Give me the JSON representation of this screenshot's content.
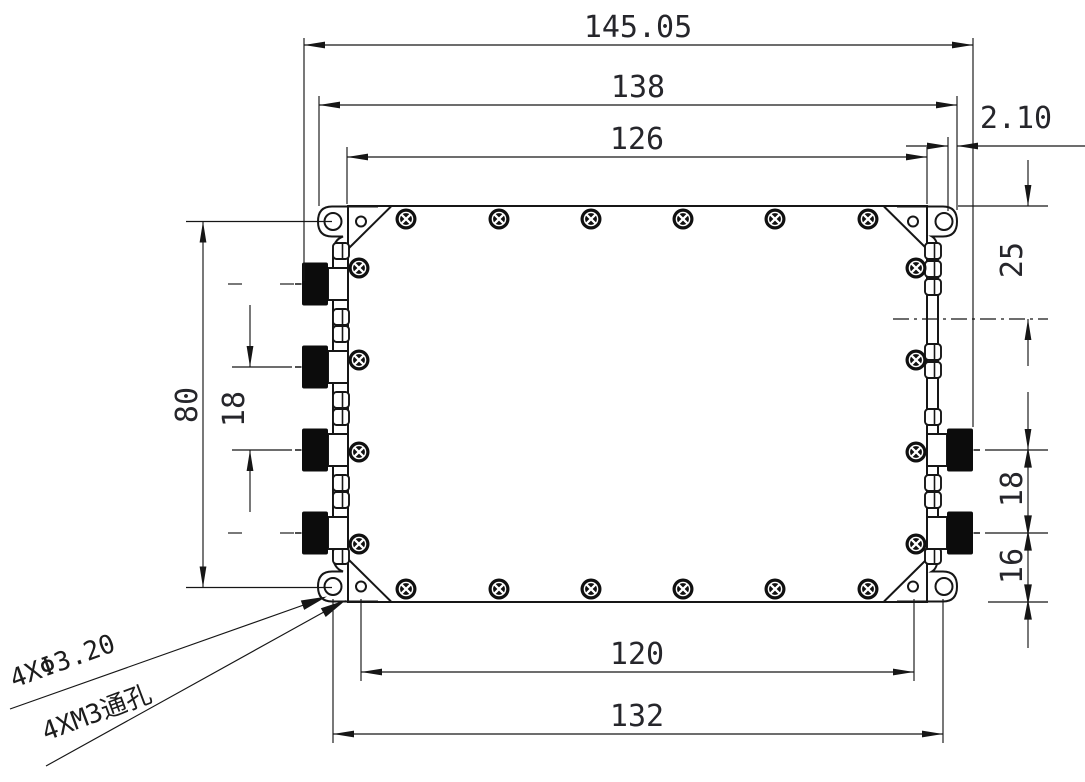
{
  "drawing": {
    "dims": {
      "total_width": "145.05",
      "mount_flange_width": "138",
      "body_width": "126",
      "tab_offset": "2.10",
      "mount_hole_row_span": "80",
      "left_port_pitch": "18",
      "right_top_to_centerline": "25",
      "right_port_pitch": "18",
      "right_port_to_bottom": "16",
      "bottom_hole_span_inner": "120",
      "bottom_hole_span_outer": "132"
    },
    "callouts": {
      "mount_hole_diameter": "4XΦ3.20",
      "mount_hole_thread": "4XM3通孔"
    },
    "hardware": {
      "left_rf_connectors": 4,
      "right_rf_connectors": 2,
      "cover_screws_top": 6,
      "cover_screws_bottom": 6,
      "cover_screws_left": 4,
      "cover_screws_right": 4,
      "corner_mount_tabs": 4,
      "holes_per_tab": 2
    },
    "colors": {
      "line": "#161616",
      "dimension_text": "#26262b",
      "connector_fill": "#0c0c0c",
      "background": "#ffffff"
    }
  }
}
